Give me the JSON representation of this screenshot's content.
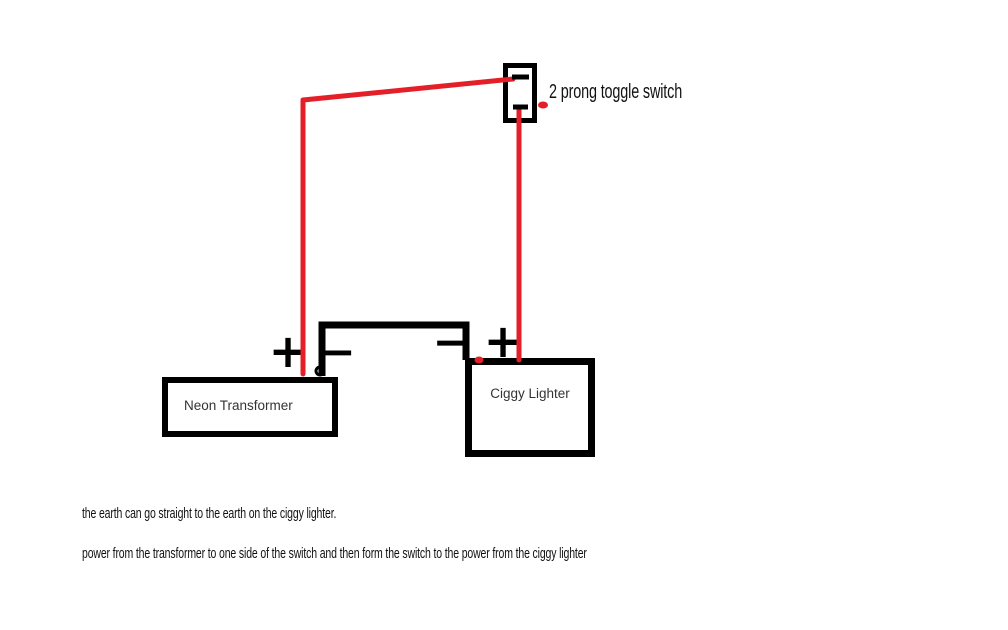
{
  "colors": {
    "background": "#ffffff",
    "wire_red": "#e41f28",
    "wire_black": "#000000",
    "box_border": "#000000",
    "device_label_text": "#333333",
    "annotation_text": "#111111"
  },
  "switch": {
    "label": "2 prong toggle switch"
  },
  "devices": {
    "transformer": {
      "label": "Neon Transformer",
      "plus_terminal": "+",
      "minus_terminal": "−"
    },
    "ciggy_lighter": {
      "label": "Ciggy Lighter",
      "minus_terminal": "−",
      "plus_terminal": "+"
    }
  },
  "notes": {
    "line1": "the earth can go straight to the earth on the ciggy lighter.",
    "line2": "power from the transformer to one side of the switch and then form the switch to the power from the ciggy lighter"
  }
}
